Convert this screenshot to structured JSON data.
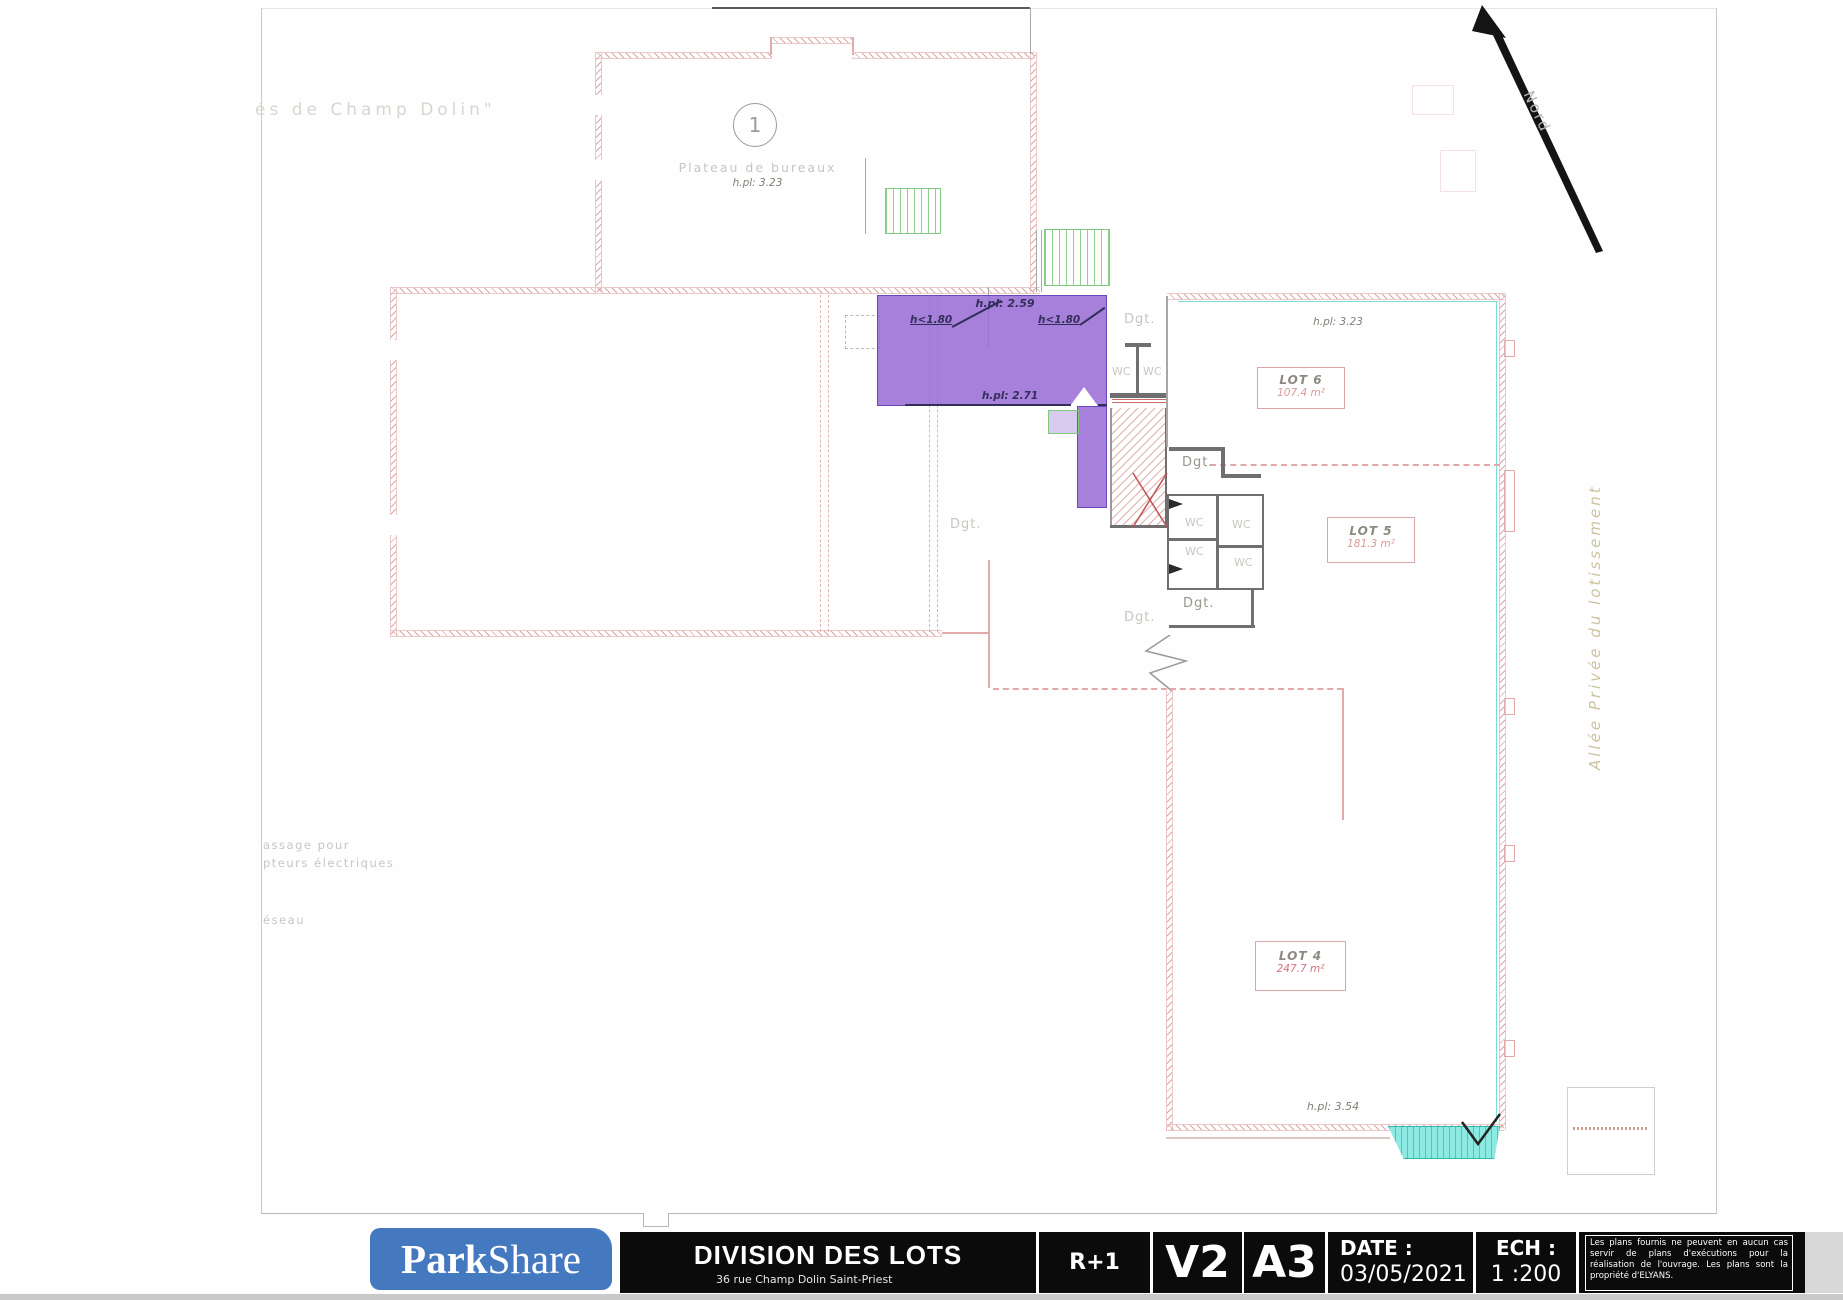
{
  "plan": {
    "frame_note": "és de Champ Dolin\"",
    "north": "Nord",
    "allee": "Allée Privée du lotissement",
    "unit1": {
      "number": "1",
      "name": "Plateau de bureaux",
      "height": "h.pl: 3.23"
    },
    "mezzanine": {
      "height_top": "h.pl: 2.59",
      "height_low_left": "h<1.80",
      "height_low_right": "h<1.80",
      "height_bottom": "h.pl: 2.71"
    },
    "lot6": {
      "name": "LOT 6",
      "area": "107.4 m²",
      "height": "h.pl: 3.23"
    },
    "lot5": {
      "name": "LOT 5",
      "area": "181.3 m²"
    },
    "lot4": {
      "name": "LOT 4",
      "area": "247.7 m²",
      "height": "h.pl: 3.54"
    },
    "labels": {
      "dgt": "Dgt.",
      "wc": "WC"
    },
    "notes": {
      "line1": "assage pour",
      "line2": "pteurs électriques",
      "line3": "éseau"
    }
  },
  "titleblock": {
    "logo": {
      "part1": "Park",
      "part2": "Share"
    },
    "title": "DIVISION DES LOTS",
    "address": "36 rue Champ Dolin Saint-Priest",
    "level": "R+1",
    "version": "V2",
    "format": "A3",
    "date_label": "DATE :",
    "date_value": "03/05/2021",
    "scale_label": "ECH :",
    "scale_value": "1 :200",
    "disclaimer": "Les plans fournis ne peuvent en aucun cas servir de plans d'exécutions pour la réalisation de l'ouvrage. Les plans sont la propriété d'ELYANS."
  },
  "colors": {
    "highlight_purple": "#966ad5",
    "plan_pink": "#dfa5a5",
    "stair_green": "#80c980",
    "ramp_cyan": "#8deae2",
    "logo_blue": "#4478bf",
    "bar_black": "#0b0b0b",
    "lot4_red": "#d97080"
  }
}
